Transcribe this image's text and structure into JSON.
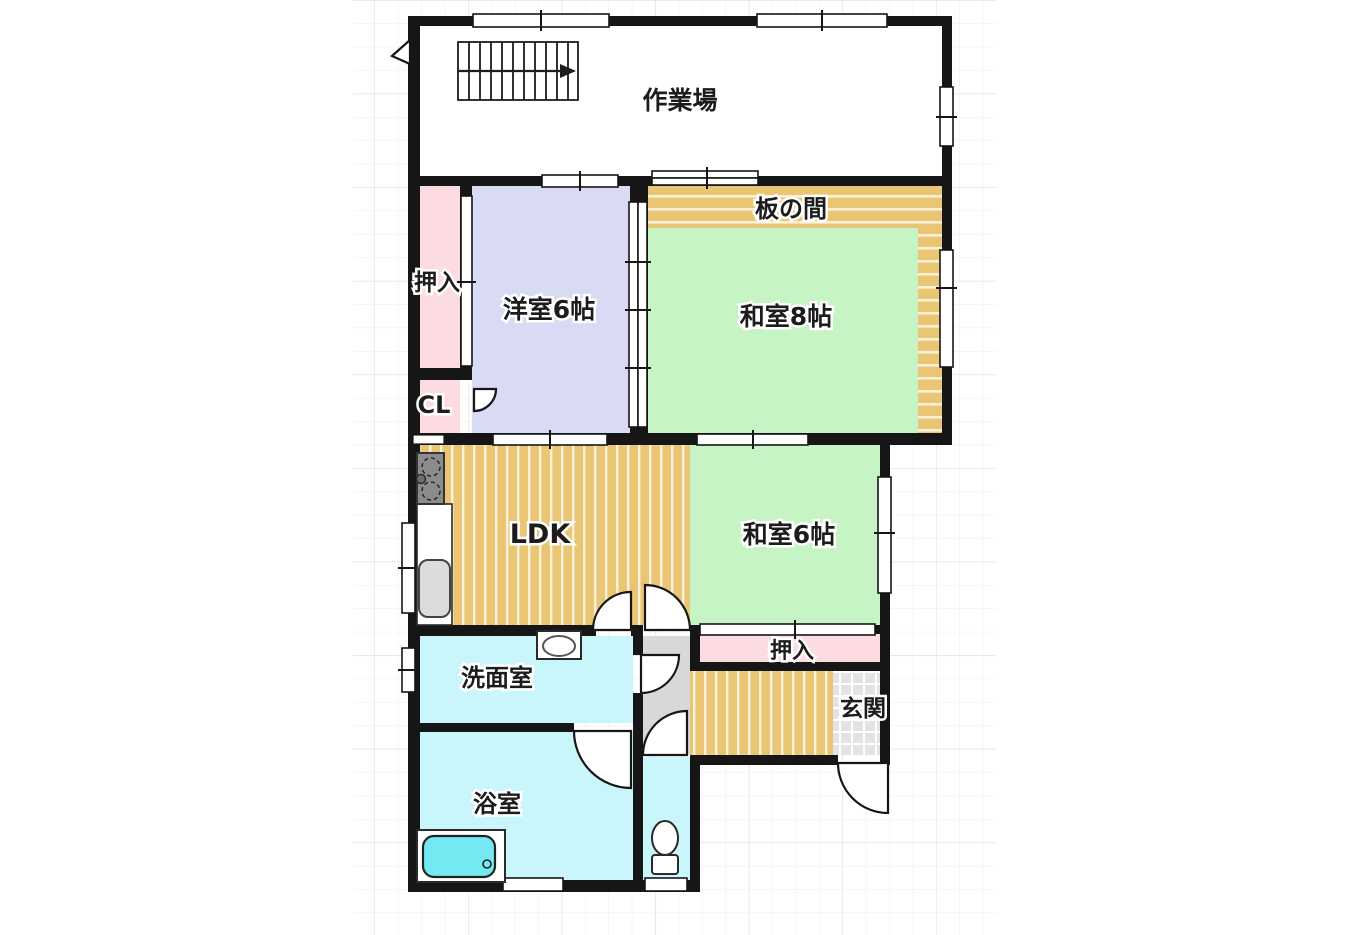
{
  "floorplan": {
    "rooms": {
      "workshop": {
        "label": "作業場"
      },
      "itanoma": {
        "label": "板の間"
      },
      "washitsu8": {
        "label": "和室8帖"
      },
      "yoshitsu6": {
        "label": "洋室6帖"
      },
      "oshiire_upper": {
        "label": "押入"
      },
      "closet": {
        "label": "CL"
      },
      "ldk": {
        "label": "LDK"
      },
      "washitsu6": {
        "label": "和室6帖"
      },
      "oshiire_lower": {
        "label": "押入"
      },
      "genkan": {
        "label": "玄関"
      },
      "senmenshitsu": {
        "label": "洗面室"
      },
      "yokushitsu": {
        "label": "浴室"
      }
    },
    "icons": {
      "stairs": "stairs-with-direction-arrow",
      "stove": "gas-stove-icon",
      "kitchen_sink": "kitchen-sink-icon",
      "wash_basin": "wash-basin-icon",
      "bathtub": "bathtub-icon",
      "toilet": "toilet-icon"
    },
    "colors": {
      "wall": "#161616",
      "wood_floor": "#eac674",
      "wood_stripe": "#f8f1da",
      "tatami_green": "#c6f4c4",
      "western_room": "#d9daf4",
      "closet_pink": "#fcdce0",
      "wet_room_cyan": "#c9f6fa",
      "bathtub_cyan": "#74e9f1",
      "hall_gray": "#d8d8d8",
      "entrance_tile": "#e3e3e3",
      "grid_line": "#ececec"
    }
  }
}
